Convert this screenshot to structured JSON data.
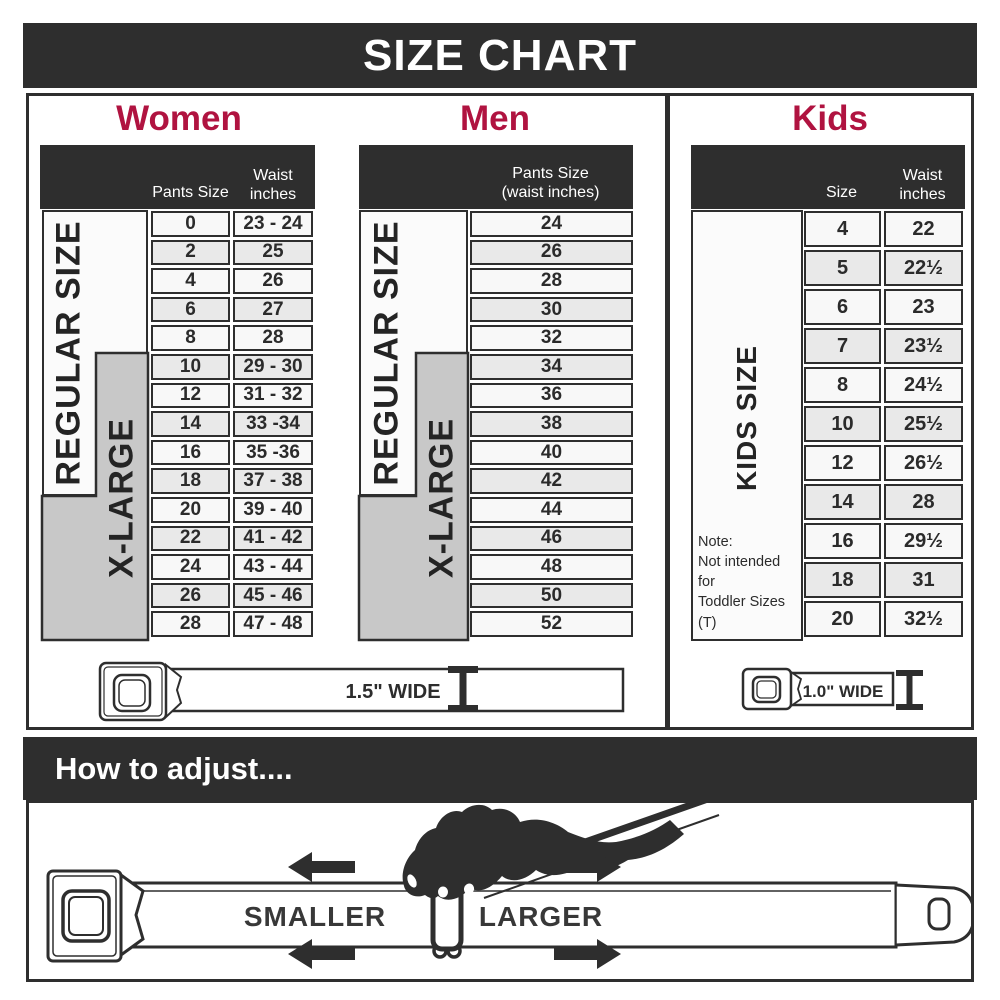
{
  "title": "SIZE CHART",
  "colors": {
    "bar_dark": "#2e2e2e",
    "heading_red": "#b01340",
    "gray_box": "#c8c8c8",
    "cell_light": "#f8f8f8",
    "cell_alt": "#e9e9e9"
  },
  "women": {
    "heading": "Women",
    "header_col1": "Pants Size",
    "header_col2a": "Waist",
    "header_col2b": "inches",
    "regular_label": "REGULAR SIZE",
    "xlarge_label": "X-LARGE",
    "belt_label": "1.5\" WIDE",
    "rows": [
      {
        "size": "0",
        "waist": "23 - 24"
      },
      {
        "size": "2",
        "waist": "25"
      },
      {
        "size": "4",
        "waist": "26"
      },
      {
        "size": "6",
        "waist": "27"
      },
      {
        "size": "8",
        "waist": "28"
      },
      {
        "size": "10",
        "waist": "29 - 30"
      },
      {
        "size": "12",
        "waist": "31 - 32"
      },
      {
        "size": "14",
        "waist": "33 -34"
      },
      {
        "size": "16",
        "waist": "35 -36"
      },
      {
        "size": "18",
        "waist": "37 - 38"
      },
      {
        "size": "20",
        "waist": "39 - 40"
      },
      {
        "size": "22",
        "waist": "41 - 42"
      },
      {
        "size": "24",
        "waist": "43 - 44"
      },
      {
        "size": "26",
        "waist": "45 - 46"
      },
      {
        "size": "28",
        "waist": "47 - 48"
      }
    ]
  },
  "men": {
    "heading": "Men",
    "header_line1": "Pants Size",
    "header_line2": "(waist inches)",
    "regular_label": "REGULAR SIZE",
    "xlarge_label": "X-LARGE",
    "rows": [
      "24",
      "26",
      "28",
      "30",
      "32",
      "34",
      "36",
      "38",
      "40",
      "42",
      "44",
      "46",
      "48",
      "50",
      "52"
    ]
  },
  "kids": {
    "heading": "Kids",
    "header_col1": "Size",
    "header_col2a": "Waist",
    "header_col2b": "inches",
    "side_label": "KIDS SIZE",
    "note_lines": [
      "Note:",
      "Not intended for",
      "Toddler Sizes (T)"
    ],
    "belt_label": "1.0\" WIDE",
    "rows": [
      {
        "size": "4",
        "waist": "22"
      },
      {
        "size": "5",
        "waist": "22½"
      },
      {
        "size": "6",
        "waist": "23"
      },
      {
        "size": "7",
        "waist": "23½"
      },
      {
        "size": "8",
        "waist": "24½"
      },
      {
        "size": "10",
        "waist": "25½"
      },
      {
        "size": "12",
        "waist": "26½"
      },
      {
        "size": "14",
        "waist": "28"
      },
      {
        "size": "16",
        "waist": "29½"
      },
      {
        "size": "18",
        "waist": "31"
      },
      {
        "size": "20",
        "waist": "32½"
      }
    ]
  },
  "adjust": {
    "heading": "How to adjust....",
    "smaller_label": "SMALLER",
    "larger_label": "LARGER"
  }
}
